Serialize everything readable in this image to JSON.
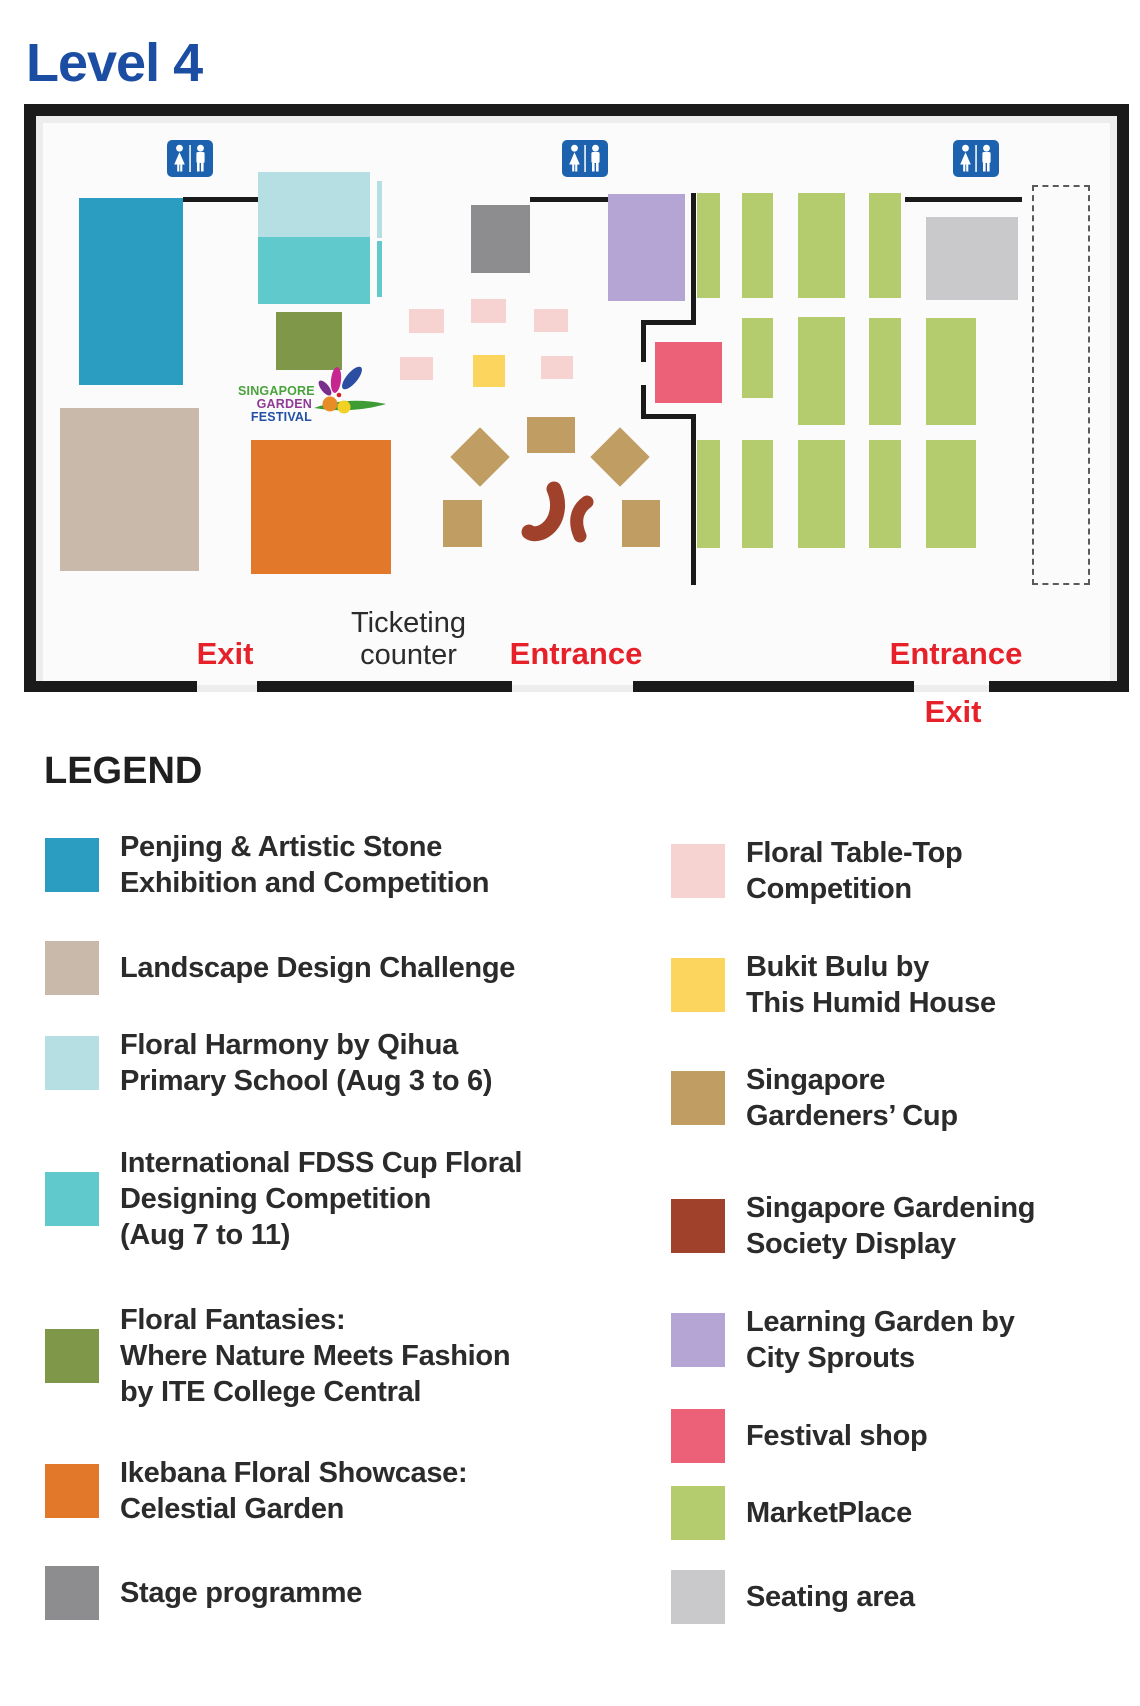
{
  "page_title": "Level 4",
  "map": {
    "wall_color": "#1a1a1a",
    "restroom_blue": "#1d62ae",
    "red_label_color": "#e62129",
    "gardening_society_color": "#a0422b",
    "labels": {
      "ticketing": [
        "Ticketing",
        "counter"
      ],
      "exit_left": "Exit",
      "entrance_left": "Entrance",
      "entrance_right": "Entrance",
      "exit_right": "Exit"
    },
    "logo": {
      "lines": [
        "SINGAPORE",
        "GARDEN",
        "FESTIVAL"
      ],
      "colors": [
        "#4aa23c",
        "#8e3a96",
        "#2150a5"
      ]
    },
    "restroom_positions": [
      {
        "x": 167,
        "y": 140
      },
      {
        "x": 562,
        "y": 140
      },
      {
        "x": 953,
        "y": 140
      }
    ],
    "walls": [
      {
        "x": 183,
        "y": 197,
        "w": 75,
        "h": 5
      },
      {
        "x": 530,
        "y": 197,
        "w": 78,
        "h": 5
      },
      {
        "x": 905,
        "y": 197,
        "w": 117,
        "h": 5
      },
      {
        "x": 691,
        "y": 193,
        "w": 5,
        "h": 132
      },
      {
        "x": 641,
        "y": 320,
        "w": 55,
        "h": 5
      },
      {
        "x": 641,
        "y": 320,
        "w": 5,
        "h": 42
      },
      {
        "x": 641,
        "y": 385,
        "w": 5,
        "h": 34
      },
      {
        "x": 641,
        "y": 414,
        "w": 55,
        "h": 5
      },
      {
        "x": 691,
        "y": 414,
        "w": 5,
        "h": 171
      }
    ],
    "bottom_wall_segments": [
      {
        "x": 24,
        "y": 681,
        "w": 173,
        "h": 11
      },
      {
        "x": 257,
        "y": 681,
        "w": 255,
        "h": 11
      },
      {
        "x": 633,
        "y": 681,
        "w": 281,
        "h": 11
      },
      {
        "x": 989,
        "y": 681,
        "w": 140,
        "h": 11
      }
    ],
    "dashed_outline": {
      "x": 1032,
      "y": 185,
      "w": 58,
      "h": 400
    },
    "zones": [
      {
        "name": "penjing-artistic-stone",
        "color": "#2a9dc0",
        "x": 79,
        "y": 198,
        "w": 104,
        "h": 187
      },
      {
        "name": "floral-harmony",
        "color": "#b5dfe3",
        "x": 258,
        "y": 172,
        "w": 112,
        "h": 65
      },
      {
        "name": "floral-harmony-strip",
        "color": "#b5dfe3",
        "x": 377,
        "y": 181,
        "w": 5,
        "h": 57
      },
      {
        "name": "international-fdss",
        "color": "#5fc9cc",
        "x": 258,
        "y": 237,
        "w": 112,
        "h": 67
      },
      {
        "name": "international-fdss-strip",
        "color": "#5fc9cc",
        "x": 377,
        "y": 241,
        "w": 5,
        "h": 56
      },
      {
        "name": "floral-fantasies",
        "color": "#7e9749",
        "x": 276,
        "y": 312,
        "w": 66,
        "h": 58
      },
      {
        "name": "landscape-design-challenge",
        "color": "#c8b9ab",
        "x": 60,
        "y": 408,
        "w": 139,
        "h": 163
      },
      {
        "name": "ikebana-floral-showcase",
        "color": "#e2792a",
        "x": 251,
        "y": 440,
        "w": 140,
        "h": 134
      },
      {
        "name": "stage-programme",
        "color": "#8d8d8f",
        "x": 471,
        "y": 205,
        "w": 59,
        "h": 68
      },
      {
        "name": "learning-garden",
        "color": "#b4a5d5",
        "x": 608,
        "y": 194,
        "w": 77,
        "h": 107
      },
      {
        "name": "floral-table-top",
        "color": "#f6d3d1",
        "x": 409,
        "y": 309,
        "w": 35,
        "h": 24
      },
      {
        "name": "floral-table-top",
        "color": "#f6d3d1",
        "x": 471,
        "y": 299,
        "w": 35,
        "h": 24
      },
      {
        "name": "floral-table-top",
        "color": "#f6d3d1",
        "x": 534,
        "y": 309,
        "w": 34,
        "h": 23
      },
      {
        "name": "floral-table-top",
        "color": "#f6d3d1",
        "x": 400,
        "y": 357,
        "w": 33,
        "h": 23
      },
      {
        "name": "floral-table-top",
        "color": "#f6d3d1",
        "x": 541,
        "y": 356,
        "w": 32,
        "h": 23
      },
      {
        "name": "bukit-bulu",
        "color": "#fbd55e",
        "x": 473,
        "y": 355,
        "w": 32,
        "h": 32
      },
      {
        "name": "festival-shop",
        "color": "#ec6078",
        "x": 655,
        "y": 342,
        "w": 67,
        "h": 61
      },
      {
        "name": "gardeners-cup",
        "color": "#c09d63",
        "x": 527,
        "y": 417,
        "w": 48,
        "h": 36
      },
      {
        "name": "gardeners-cup",
        "color": "#c09d63",
        "x": 459,
        "y": 436,
        "w": 42,
        "h": 42,
        "rotate": 45
      },
      {
        "name": "gardeners-cup",
        "color": "#c09d63",
        "x": 599,
        "y": 436,
        "w": 42,
        "h": 42,
        "rotate": 45
      },
      {
        "name": "gardeners-cup",
        "color": "#c09d63",
        "x": 443,
        "y": 500,
        "w": 39,
        "h": 47
      },
      {
        "name": "gardeners-cup",
        "color": "#c09d63",
        "x": 622,
        "y": 500,
        "w": 38,
        "h": 47
      },
      {
        "name": "marketplace",
        "color": "#b4cc6e",
        "x": 697,
        "y": 193,
        "w": 23,
        "h": 105
      },
      {
        "name": "marketplace",
        "color": "#b4cc6e",
        "x": 742,
        "y": 193,
        "w": 31,
        "h": 105
      },
      {
        "name": "marketplace",
        "color": "#b4cc6e",
        "x": 798,
        "y": 193,
        "w": 47,
        "h": 105
      },
      {
        "name": "marketplace",
        "color": "#b4cc6e",
        "x": 869,
        "y": 193,
        "w": 32,
        "h": 105
      },
      {
        "name": "marketplace",
        "color": "#b4cc6e",
        "x": 742,
        "y": 318,
        "w": 31,
        "h": 80
      },
      {
        "name": "marketplace",
        "color": "#b4cc6e",
        "x": 798,
        "y": 317,
        "w": 47,
        "h": 108
      },
      {
        "name": "marketplace",
        "color": "#b4cc6e",
        "x": 869,
        "y": 318,
        "w": 32,
        "h": 107
      },
      {
        "name": "marketplace",
        "color": "#b4cc6e",
        "x": 926,
        "y": 318,
        "w": 50,
        "h": 107
      },
      {
        "name": "marketplace",
        "color": "#b4cc6e",
        "x": 697,
        "y": 440,
        "w": 23,
        "h": 108
      },
      {
        "name": "marketplace",
        "color": "#b4cc6e",
        "x": 742,
        "y": 440,
        "w": 31,
        "h": 108
      },
      {
        "name": "marketplace",
        "color": "#b4cc6e",
        "x": 798,
        "y": 440,
        "w": 47,
        "h": 108
      },
      {
        "name": "marketplace",
        "color": "#b4cc6e",
        "x": 869,
        "y": 440,
        "w": 32,
        "h": 108
      },
      {
        "name": "marketplace",
        "color": "#b4cc6e",
        "x": 926,
        "y": 440,
        "w": 50,
        "h": 108
      },
      {
        "name": "seating-area",
        "color": "#c9c9cb",
        "x": 926,
        "y": 217,
        "w": 92,
        "h": 83
      }
    ]
  },
  "legend": {
    "title": "LEGEND",
    "left": [
      {
        "name": "penjing-artistic-stone",
        "color": "#2a9dc0",
        "label": [
          "Penjing & Artistic Stone",
          "Exhibition and Competition"
        ]
      },
      {
        "name": "landscape-design-challenge",
        "color": "#c8b9ab",
        "label": [
          "Landscape Design Challenge"
        ]
      },
      {
        "name": "floral-harmony",
        "color": "#b5dfe3",
        "label": [
          "Floral Harmony by Qihua",
          "Primary School (Aug 3 to 6)"
        ]
      },
      {
        "name": "international-fdss",
        "color": "#5fc9cc",
        "label": [
          "International FDSS Cup Floral",
          "Designing Competition",
          "(Aug 7 to 11)"
        ]
      },
      {
        "name": "floral-fantasies",
        "color": "#7e9749",
        "label": [
          "Floral Fantasies:",
          "Where Nature Meets Fashion",
          "by ITE College Central"
        ]
      },
      {
        "name": "ikebana-floral-showcase",
        "color": "#e2792a",
        "label": [
          "Ikebana Floral Showcase:",
          "Celestial Garden"
        ]
      },
      {
        "name": "stage-programme",
        "color": "#8d8d8f",
        "label": [
          "Stage programme"
        ]
      }
    ],
    "right": [
      {
        "name": "floral-table-top",
        "color": "#f6d3d1",
        "label": [
          "Floral Table-Top",
          "Competition"
        ]
      },
      {
        "name": "bukit-bulu",
        "color": "#fbd55e",
        "label": [
          "Bukit Bulu by",
          "This Humid House"
        ]
      },
      {
        "name": "gardeners-cup",
        "color": "#c09d63",
        "label": [
          "Singapore",
          "Gardeners’ Cup"
        ]
      },
      {
        "name": "gardening-society",
        "color": "#a0422b",
        "label": [
          "Singapore Gardening",
          "Society Display"
        ]
      },
      {
        "name": "learning-garden",
        "color": "#b4a5d5",
        "label": [
          "Learning Garden by",
          "City Sprouts"
        ]
      },
      {
        "name": "festival-shop",
        "color": "#ec6078",
        "label": [
          "Festival shop"
        ]
      },
      {
        "name": "marketplace",
        "color": "#b4cc6e",
        "label": [
          "MarketPlace"
        ]
      },
      {
        "name": "seating-area",
        "color": "#c9c9cb",
        "label": [
          "Seating area"
        ]
      }
    ]
  }
}
